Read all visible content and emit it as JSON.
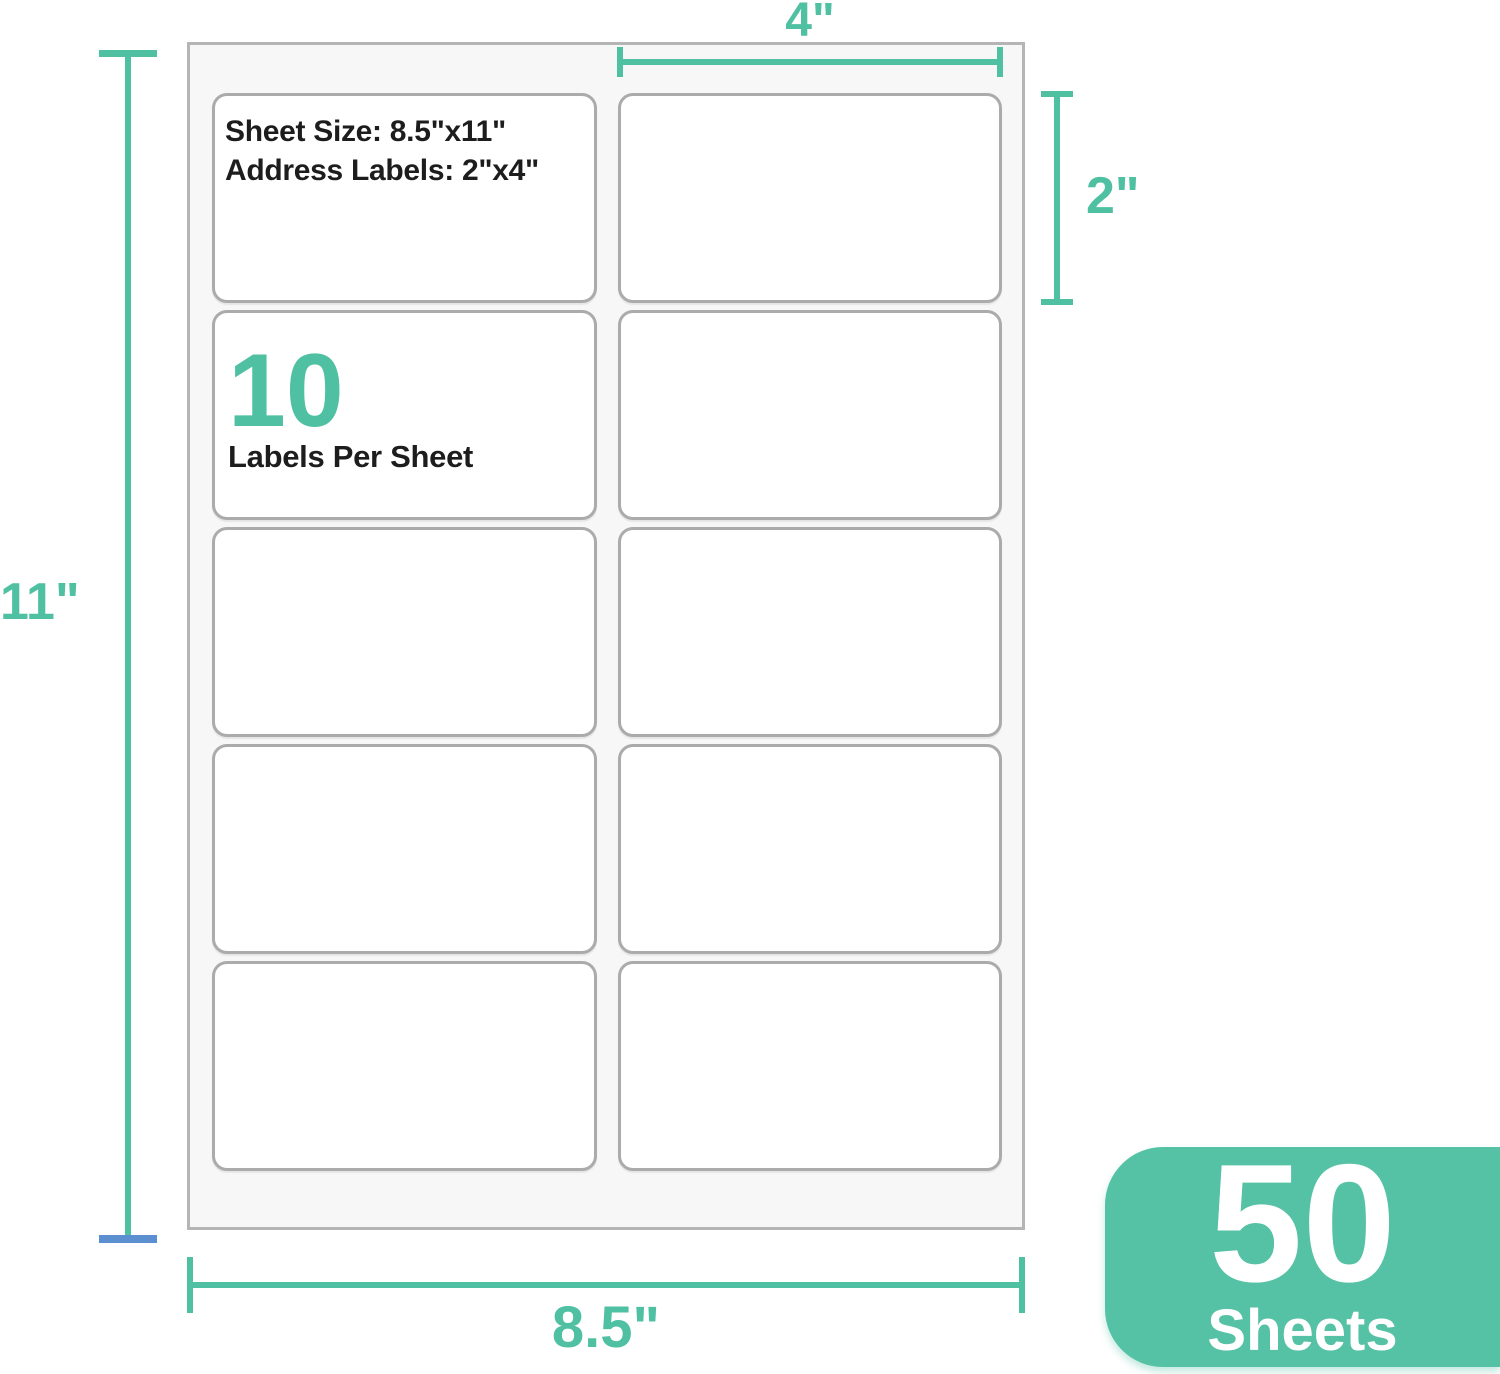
{
  "colors": {
    "teal": "#4FC0A2",
    "blue": "#5C8FD0",
    "label_border": "#ABABAB",
    "sheet_border": "#B5B5B5",
    "sheet_bg": "#F7F7F7",
    "text_dark": "#1D1D1D",
    "badge_bg": "#55C1A5",
    "badge_text": "#FFFFFF",
    "page_bg": "#FFFFFF"
  },
  "sheet": {
    "info": {
      "line1": "Sheet Size: 8.5\"x11\"",
      "line2": "Address Labels: 2\"x4\""
    },
    "count": {
      "value": "10",
      "caption": "Labels Per Sheet"
    },
    "grid": {
      "rows": 5,
      "columns": 2,
      "total_labels": 10
    }
  },
  "dimensions": {
    "label_width": "4\"",
    "label_height": "2\"",
    "sheet_height": "11\"",
    "sheet_width": "8.5\""
  },
  "badge": {
    "count": "50",
    "unit": "Sheets"
  }
}
